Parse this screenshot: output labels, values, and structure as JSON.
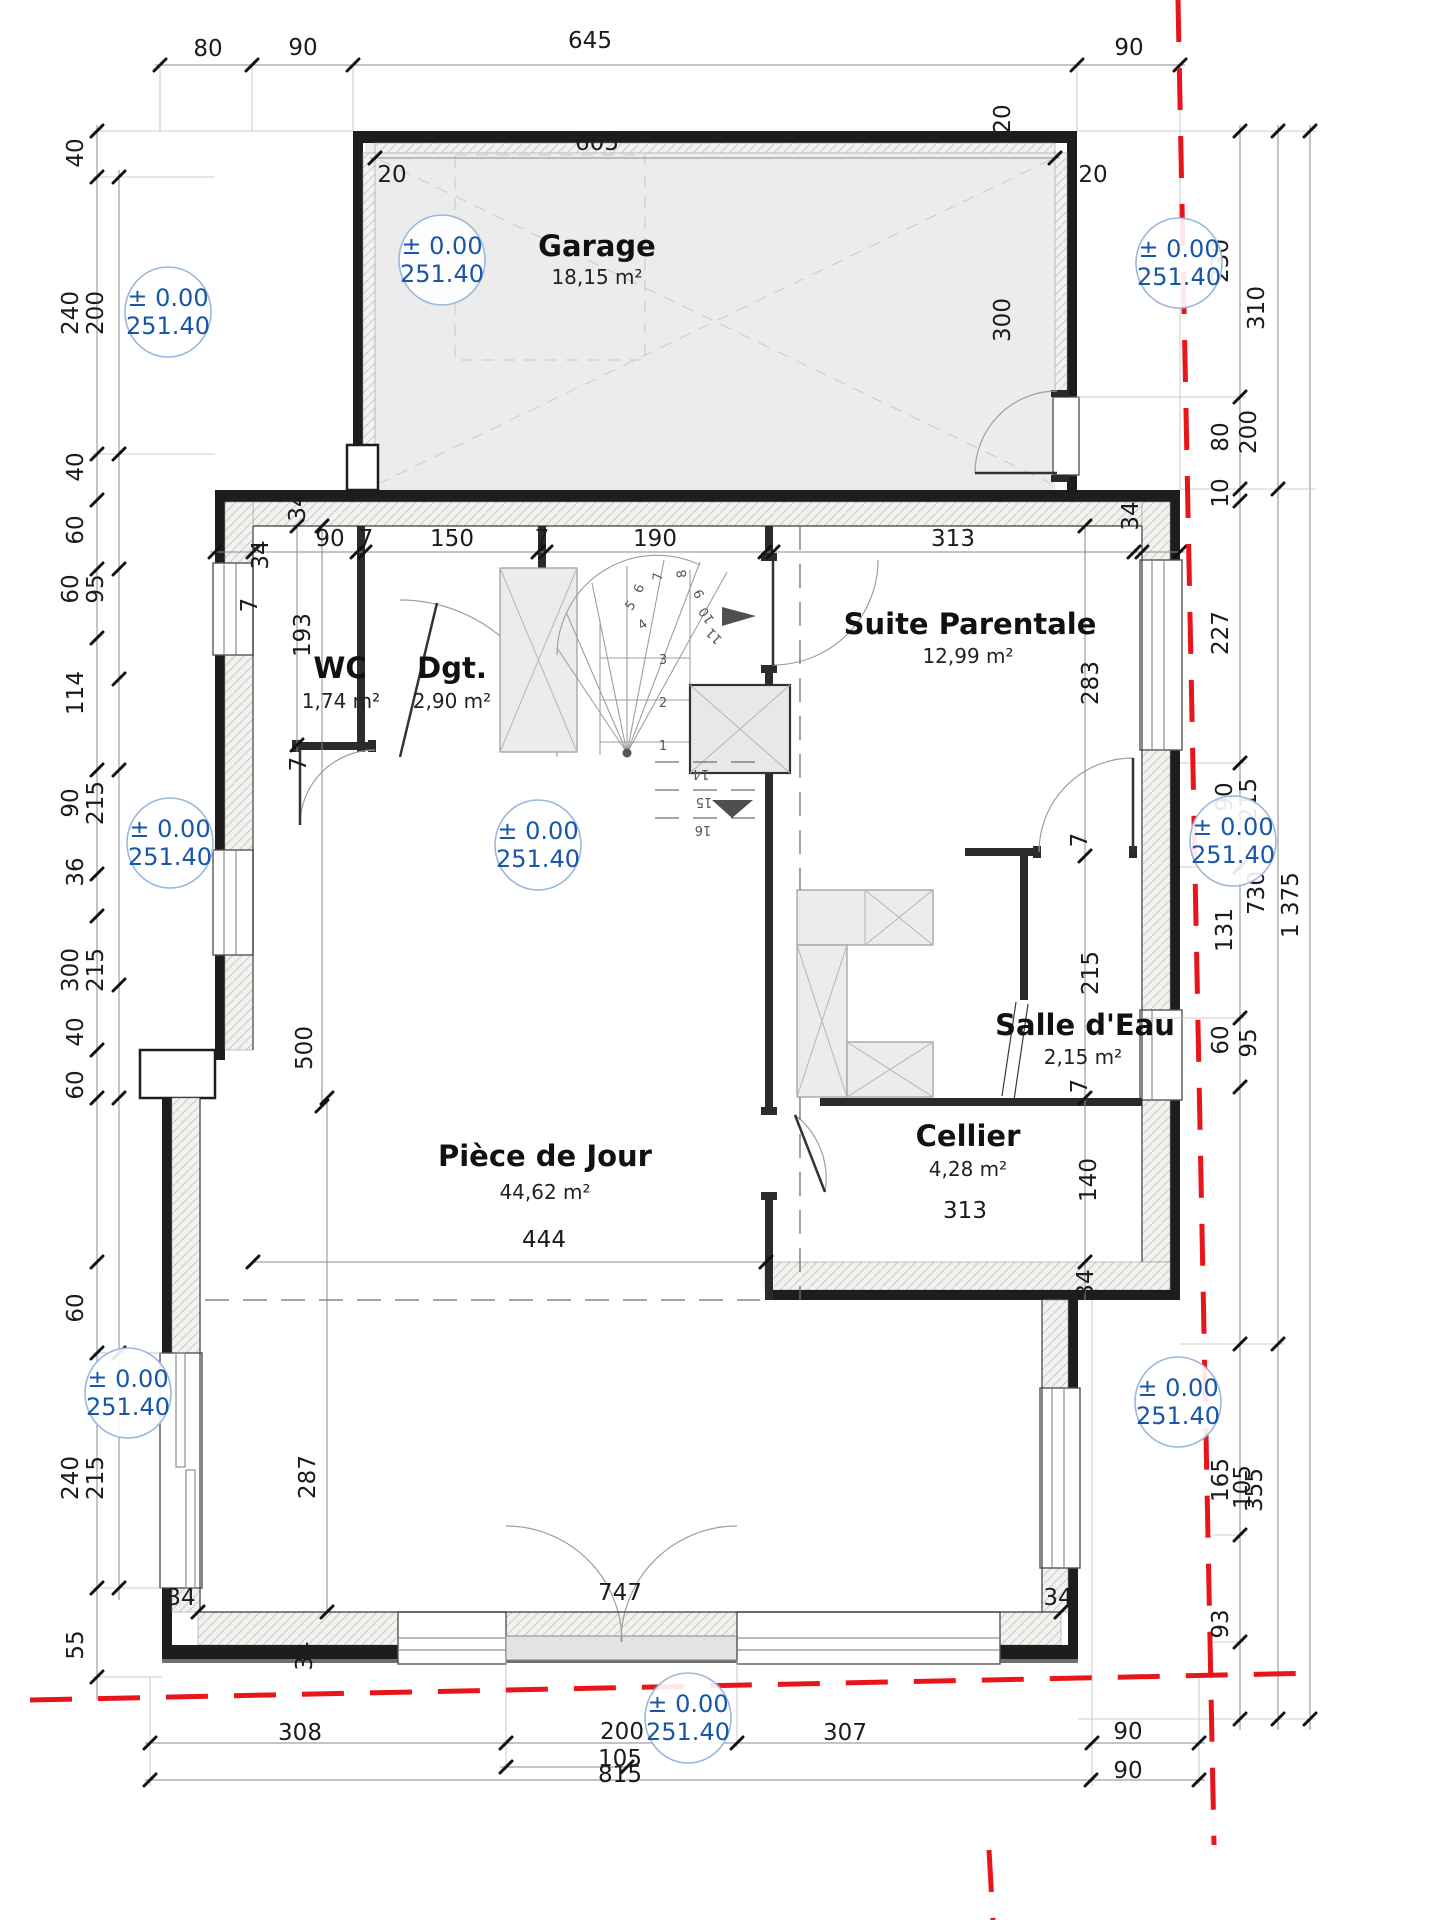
{
  "drawing": {
    "kind": "floor-plan"
  },
  "colors": {
    "boundary_red": "#e8151b",
    "elevation_blue": "#1857a8",
    "elevation_ring": "#9ab8dd",
    "wall_black": "#1d1d1d",
    "room_fill": "#ececec"
  },
  "elevation": {
    "line1": "± 0.00",
    "line2": "251.40",
    "positions": [
      {
        "x": 168,
        "y": 312
      },
      {
        "x": 442,
        "y": 260
      },
      {
        "x": 1179,
        "y": 263
      },
      {
        "x": 170,
        "y": 843
      },
      {
        "x": 538,
        "y": 845
      },
      {
        "x": 1233,
        "y": 841
      },
      {
        "x": 128,
        "y": 1393
      },
      {
        "x": 1178,
        "y": 1402
      },
      {
        "x": 688,
        "y": 1718
      }
    ]
  },
  "rooms": [
    {
      "name": "Garage",
      "area": "18,15 m²",
      "nx": 597,
      "ny": 256,
      "ax": 597,
      "ay": 284
    },
    {
      "name": "WC",
      "area": "1,74 m²",
      "nx": 340,
      "ny": 678,
      "ax": 341,
      "ay": 708
    },
    {
      "name": "Dgt.",
      "area": "2,90 m²",
      "nx": 452,
      "ny": 678,
      "ax": 452,
      "ay": 708
    },
    {
      "name": "Suite Parentale",
      "area": "12,99 m²",
      "nx": 970,
      "ny": 634,
      "ax": 968,
      "ay": 663
    },
    {
      "name": "Salle d'Eau",
      "area": "2,15 m²",
      "nx": 1085,
      "ny": 1035,
      "ax": 1083,
      "ay": 1064
    },
    {
      "name": "Cellier",
      "area": "4,28 m²",
      "nx": 968,
      "ny": 1146,
      "ax": 968,
      "ay": 1176
    },
    {
      "name": "Pièce de Jour",
      "area": "44,62 m²",
      "nx": 545,
      "ny": 1166,
      "ax": 545,
      "ay": 1199
    }
  ],
  "dim_labels": [
    {
      "t": "80",
      "x": 208,
      "y": 56
    },
    {
      "t": "90",
      "x": 303,
      "y": 55
    },
    {
      "t": "645",
      "x": 590,
      "y": 48
    },
    {
      "t": "90",
      "x": 1129,
      "y": 55
    },
    {
      "t": "605",
      "x": 597,
      "y": 150
    },
    {
      "t": "20",
      "x": 392,
      "y": 182
    },
    {
      "t": "20",
      "x": 1093,
      "y": 182
    },
    {
      "t": "20",
      "x": 1010,
      "y": 119,
      "r": -90
    },
    {
      "t": "34",
      "x": 305,
      "y": 507,
      "r": -90
    },
    {
      "t": "34",
      "x": 268,
      "y": 555,
      "r": -90
    },
    {
      "t": "90",
      "x": 330,
      "y": 546
    },
    {
      "t": "7",
      "x": 366,
      "y": 546
    },
    {
      "t": "150",
      "x": 452,
      "y": 546
    },
    {
      "t": "7",
      "x": 542,
      "y": 546
    },
    {
      "t": "190",
      "x": 655,
      "y": 546
    },
    {
      "t": "313",
      "x": 953,
      "y": 546
    },
    {
      "t": "34",
      "x": 1138,
      "y": 516,
      "r": -90
    },
    {
      "t": "193",
      "x": 310,
      "y": 635,
      "r": -90
    },
    {
      "t": "7",
      "x": 257,
      "y": 605,
      "r": -90
    },
    {
      "t": "7",
      "x": 306,
      "y": 764,
      "r": -90
    },
    {
      "t": "283",
      "x": 1098,
      "y": 683,
      "r": -90
    },
    {
      "t": "7",
      "x": 1087,
      "y": 840,
      "r": -90
    },
    {
      "t": "215",
      "x": 1098,
      "y": 973,
      "r": -90
    },
    {
      "t": "7",
      "x": 1087,
      "y": 1086,
      "r": -90
    },
    {
      "t": "140",
      "x": 1096,
      "y": 1180,
      "r": -90
    },
    {
      "t": "34",
      "x": 1093,
      "y": 1284,
      "r": -90
    },
    {
      "t": "313",
      "x": 965,
      "y": 1218
    },
    {
      "t": "444",
      "x": 544,
      "y": 1247
    },
    {
      "t": "500",
      "x": 312,
      "y": 1048,
      "r": -90
    },
    {
      "t": "287",
      "x": 315,
      "y": 1477,
      "r": -90
    },
    {
      "t": "747",
      "x": 620,
      "y": 1600
    },
    {
      "t": "34",
      "x": 181,
      "y": 1605
    },
    {
      "t": "34",
      "x": 1058,
      "y": 1605
    },
    {
      "t": "34",
      "x": 312,
      "y": 1656,
      "r": -90
    },
    {
      "t": "40",
      "x": 83,
      "y": 153,
      "r": -90
    },
    {
      "t": "240",
      "x": 78,
      "y": 313,
      "r": -90
    },
    {
      "t": "200",
      "x": 103,
      "y": 313,
      "r": -90
    },
    {
      "t": "40",
      "x": 83,
      "y": 467,
      "r": -90
    },
    {
      "t": "60",
      "x": 83,
      "y": 530,
      "r": -90
    },
    {
      "t": "60",
      "x": 78,
      "y": 589,
      "r": -90
    },
    {
      "t": "95",
      "x": 103,
      "y": 589,
      "r": -90
    },
    {
      "t": "114",
      "x": 83,
      "y": 693,
      "r": -90
    },
    {
      "t": "90",
      "x": 78,
      "y": 803,
      "r": -90
    },
    {
      "t": "215",
      "x": 103,
      "y": 803,
      "r": -90
    },
    {
      "t": "36",
      "x": 83,
      "y": 872,
      "r": -90
    },
    {
      "t": "300",
      "x": 78,
      "y": 970,
      "r": -90
    },
    {
      "t": "215",
      "x": 103,
      "y": 970,
      "r": -90
    },
    {
      "t": "40",
      "x": 83,
      "y": 1032,
      "r": -90
    },
    {
      "t": "60",
      "x": 83,
      "y": 1085,
      "r": -90
    },
    {
      "t": "60",
      "x": 83,
      "y": 1308,
      "r": -90
    },
    {
      "t": "240",
      "x": 78,
      "y": 1478,
      "r": -90
    },
    {
      "t": "215",
      "x": 103,
      "y": 1478,
      "r": -90
    },
    {
      "t": "55",
      "x": 83,
      "y": 1645,
      "r": -90
    },
    {
      "t": "230",
      "x": 1228,
      "y": 261,
      "r": -90
    },
    {
      "t": "310",
      "x": 1264,
      "y": 308,
      "r": -90
    },
    {
      "t": "300",
      "x": 1010,
      "y": 320,
      "r": -90
    },
    {
      "t": "80",
      "x": 1228,
      "y": 437,
      "r": -90
    },
    {
      "t": "200",
      "x": 1256,
      "y": 432,
      "r": -90
    },
    {
      "t": "10",
      "x": 1228,
      "y": 493,
      "r": -90
    },
    {
      "t": "227",
      "x": 1228,
      "y": 633,
      "r": -90
    },
    {
      "t": "90",
      "x": 1232,
      "y": 797,
      "r": -90
    },
    {
      "t": "215",
      "x": 1256,
      "y": 800,
      "r": -90
    },
    {
      "t": "730",
      "x": 1264,
      "y": 893,
      "r": -90
    },
    {
      "t": "1 375",
      "x": 1298,
      "y": 905,
      "r": -90
    },
    {
      "t": "131",
      "x": 1232,
      "y": 930,
      "r": -90
    },
    {
      "t": "60",
      "x": 1228,
      "y": 1040,
      "r": -90
    },
    {
      "t": "95",
      "x": 1256,
      "y": 1043,
      "r": -90
    },
    {
      "t": "165",
      "x": 1228,
      "y": 1480,
      "r": -90
    },
    {
      "t": "105",
      "x": 1250,
      "y": 1487,
      "r": -90
    },
    {
      "t": "355",
      "x": 1262,
      "y": 1490,
      "r": -90
    },
    {
      "t": "93",
      "x": 1228,
      "y": 1624,
      "r": -90
    },
    {
      "t": "308",
      "x": 300,
      "y": 1740
    },
    {
      "t": "200",
      "x": 622,
      "y": 1739
    },
    {
      "t": "307",
      "x": 845,
      "y": 1740
    },
    {
      "t": "90",
      "x": 1128,
      "y": 1739
    },
    {
      "t": "105",
      "x": 620,
      "y": 1766
    },
    {
      "t": "815",
      "x": 620,
      "y": 1782
    },
    {
      "t": "90",
      "x": 1128,
      "y": 1778
    }
  ],
  "stair_numbers": [
    {
      "t": "1",
      "x": 663,
      "y": 750
    },
    {
      "t": "2",
      "x": 663,
      "y": 707
    },
    {
      "t": "3",
      "x": 663,
      "y": 664
    },
    {
      "t": "4",
      "x": 645,
      "y": 628,
      "r": -35
    },
    {
      "t": "5",
      "x": 634,
      "y": 608,
      "r": -55
    },
    {
      "t": "6",
      "x": 643,
      "y": 590,
      "r": -70
    },
    {
      "t": "7",
      "x": 662,
      "y": 577,
      "r": -85
    },
    {
      "t": "8",
      "x": 686,
      "y": 573,
      "r": -100
    },
    {
      "t": "9",
      "x": 703,
      "y": 592,
      "r": -115
    },
    {
      "t": "10",
      "x": 710,
      "y": 613,
      "r": -125
    },
    {
      "t": "11",
      "x": 717,
      "y": 633,
      "r": -135
    },
    {
      "t": "14",
      "x": 701,
      "y": 770,
      "r": 180
    },
    {
      "t": "15",
      "x": 704,
      "y": 798,
      "r": 180
    },
    {
      "t": "16",
      "x": 703,
      "y": 826,
      "r": 180
    }
  ]
}
